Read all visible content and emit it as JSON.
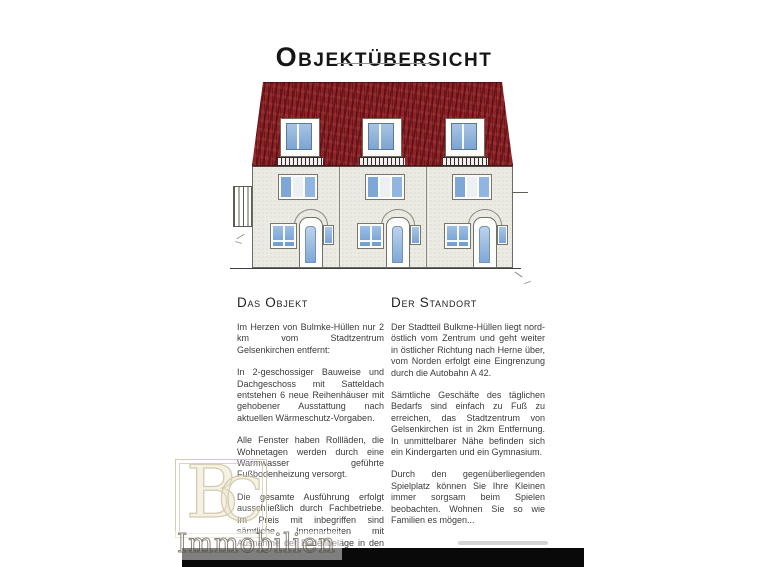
{
  "page": {
    "title": "Objektübersicht"
  },
  "drawing": {
    "name": "row-house-front-elevation",
    "units": 3,
    "colors": {
      "roof": "#8e2327",
      "facade": "#ecebe3",
      "glass": "#7ea7d8",
      "watermark_gold": "#cfc5a4"
    }
  },
  "sections": {
    "left": {
      "heading": "Das Objekt",
      "paragraphs": [
        "Im Herzen von Bulmke-Hüllen nur 2 km vom Stadtzentrum Gelsenkirchen entfernt:",
        "In 2-geschossiger Bauweise und Dachgeschoss mit Satteldach entstehen 6 neue Reihenhäuser mit gehobener Ausstattung nach aktuellen Wärmeschutz-Vorgaben.",
        "Alle Fenster haben Rollläden, die Wohnetagen werden durch eine Warmwasser geführte Fußbodenheizung versorgt.",
        "Die gesamte Ausführung erfolgt ausschließlich durch Fachbetriebe. Im Preis mit inbegriffen sind sämtliche Innenarbeiten mit Ausnahme der Bodenbeläge in den Wohnräumen und den Maler- und Lackierarbeiten."
      ]
    },
    "right": {
      "heading": "Der Standort",
      "paragraphs": [
        "Der Stadtteil Bulkme-Hüllen liegt nord-östlich vom Zentrum und geht weiter in östlicher Richtung nach Herne über, vom Norden erfolgt eine Eingrenzung durch die Autobahn A 42.",
        "Sämtliche Geschäfte des täglichen Bedarfs sind einfach zu Fuß zu erreichen, das Stadtzentrum von Gelsenkirchen ist in 2km Entfernung. In unmittelbarer Nähe befinden sich ein Kindergarten und ein Gymnasium.",
        "Durch den gegenüberliegenden Spielplatz können Sie Ihre Kleinen immer sorgsam beim Spielen beobachten. Wohnen Sie so wie Familien es mögen..."
      ]
    }
  },
  "watermark": {
    "letter_b": "B",
    "letter_c": "C",
    "label": "Immobilien"
  }
}
